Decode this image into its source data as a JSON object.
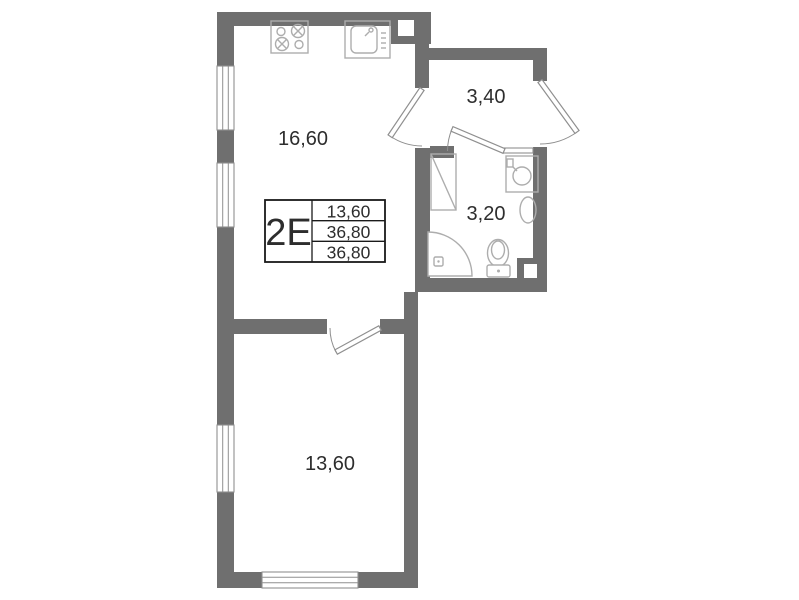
{
  "plan": {
    "unit_label": "2Е",
    "info_table": {
      "rows": [
        "13,60",
        "36,80",
        "36,80"
      ]
    },
    "rooms": [
      {
        "name": "kitchen-living-room",
        "area": "16,60"
      },
      {
        "name": "hallway",
        "area": "3,40"
      },
      {
        "name": "bathroom",
        "area": "3,20"
      },
      {
        "name": "bedroom",
        "area": "13,60"
      }
    ],
    "fixtures": [
      "stove-icon",
      "kitchen-sink-icon",
      "washing-machine-icon",
      "washbasin-icon",
      "towel-radiator-icon",
      "shower-tray-icon",
      "toilet-icon",
      "vent-shaft-icon"
    ]
  },
  "colors": {
    "wall": "#6f6f6f",
    "door": "#8f8f8f",
    "fixture": "#adadad",
    "text": "#2d2d2d",
    "table_border": "#1a1a1a",
    "background": "#ffffff"
  }
}
